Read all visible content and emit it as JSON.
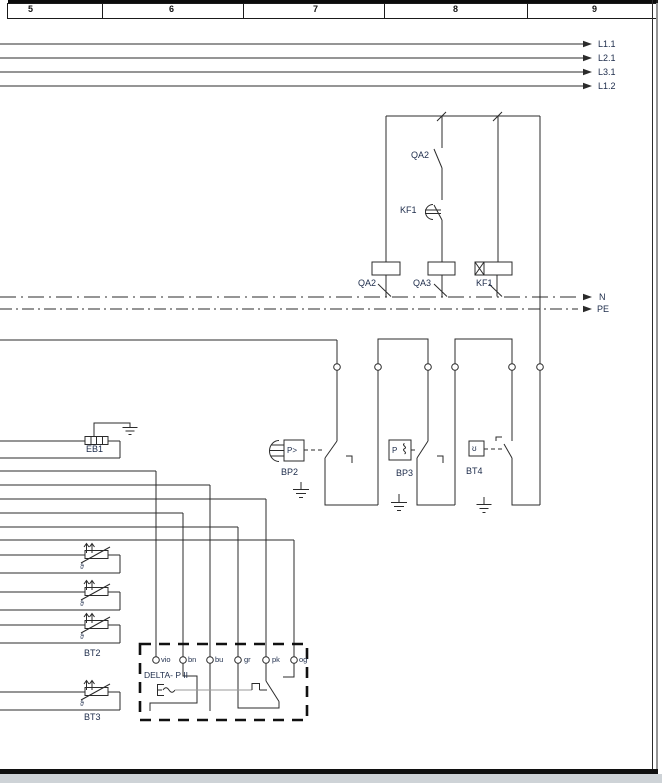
{
  "ruler": {
    "cells": [
      "5",
      "6",
      "7",
      "8",
      "9"
    ]
  },
  "nets": {
    "l1_1": "L1.1",
    "l2_1": "L2.1",
    "l3_1": "L3.1",
    "l1_2": "L1.2",
    "neutral": "N",
    "pe": "PE"
  },
  "control": {
    "contact_qa2": "QA2",
    "contact_kf1": "KF1",
    "coil_qa2": "QA2",
    "coil_qa3": "QA3",
    "coil_kf1": "KF1"
  },
  "components": {
    "eb1": "EB1",
    "bp2": "BP2",
    "bp3": "BP3",
    "bt4": "BT4",
    "bt2": "BT2",
    "bt3": "BT3",
    "bp2_symbol": "P>",
    "bp3_symbol": "P",
    "bt4_symbol": "ʊ",
    "thermistor_symbol": "ϑ"
  },
  "delta_module": {
    "title": "DELTA- P II",
    "terminals": [
      "vio",
      "bn",
      "bu",
      "gr",
      "pk",
      "og"
    ]
  },
  "colors": {
    "line": "#2b2b2b",
    "text": "#1c2b4a",
    "actuator_grey": "#9a9a9a",
    "footer_grey": "#ced3d7",
    "border_black": "#111111"
  }
}
